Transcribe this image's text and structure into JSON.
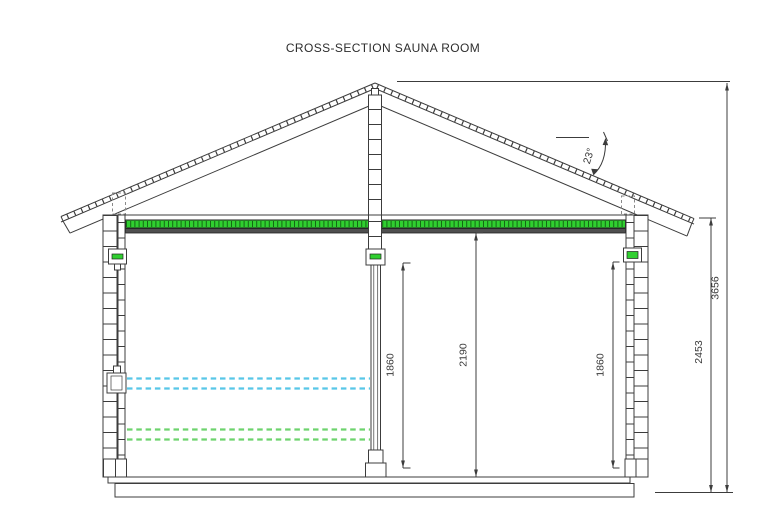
{
  "title": "CROSS-SECTION SAUNA ROOM",
  "roof": {
    "angle_label": "23°"
  },
  "dimensions": {
    "overall_height": "3656",
    "eave_height": "2453",
    "room_height": "2190",
    "left_opening_height": "1860",
    "right_opening_height": "1860"
  },
  "colors": {
    "line": "#3c3c3c",
    "ceiling_green": "#30cf30",
    "ceiling_tick": "#146914",
    "ceiling_dark": "#4f4f4f",
    "vent_green": "#30cf30",
    "bench_upper_dashed": "#58c6e8",
    "bench_lower_dashed": "#6ed36e"
  }
}
